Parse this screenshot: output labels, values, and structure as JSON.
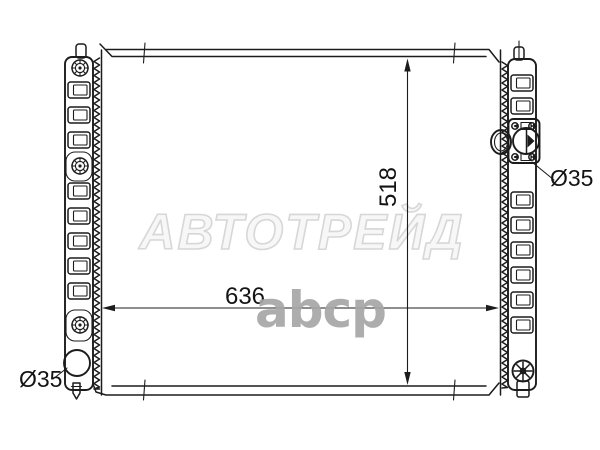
{
  "page": {
    "background": "#ffffff"
  },
  "watermark": {
    "brand": "АВТОТРЕЙД",
    "logo": "abcp",
    "outline_color": "#d7d7d7",
    "logo_color": "#a7a7a7"
  },
  "diagram": {
    "subject": "car radiator outline schematic, front view with side tanks",
    "line_color": "#1c1c1c",
    "labels": {
      "core_width": "636",
      "core_height": "518",
      "left_outlet_diameter": "Ø35",
      "right_inlet_diameter": "Ø35"
    }
  }
}
